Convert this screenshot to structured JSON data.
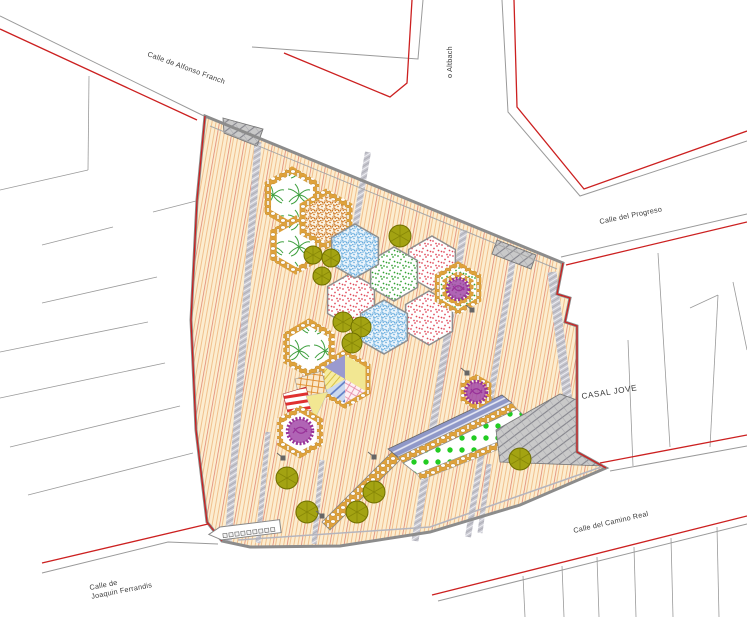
{
  "labels": {
    "street_alfonso_franch": "Calle de Alfonso Franch",
    "street_altbach_fragment": "o Altbach",
    "street_progreso": "Calle del Progreso",
    "building_casal_jove": "CASAL JOVE",
    "street_camino_real": "Calle del Camino Real",
    "street_joaquin_line1": "Calle de",
    "street_joaquin_line2": "Joaquin Ferrandis"
  },
  "palette": {
    "plaza_bg": "#FCEDD0",
    "plaza_line": "#EFB57C",
    "plaza_red": "#E08672",
    "band_gray": "#C7C7CF",
    "stone": "#DFA23B",
    "stipple_orange": "#C96A10",
    "stipple_blue": "#5FA8DC",
    "stipple_green": "#2FA02F",
    "stipple_pink": "#E04858",
    "palm_green": "#3FA03F",
    "tree_olive": "#A3A312",
    "tree_purple": "#993399",
    "ramp_blue": "#8F98C8",
    "green_dot": "#22CC22",
    "play_yellow": "#F2E792",
    "play_lavender": "#9A9ACF",
    "red_stripe": "#E03030",
    "hatch_gray": "#C9C9C9",
    "line_gray": "#9A9A9A",
    "boundary_red": "#CC2020",
    "label_color": "#3A3A3A"
  }
}
